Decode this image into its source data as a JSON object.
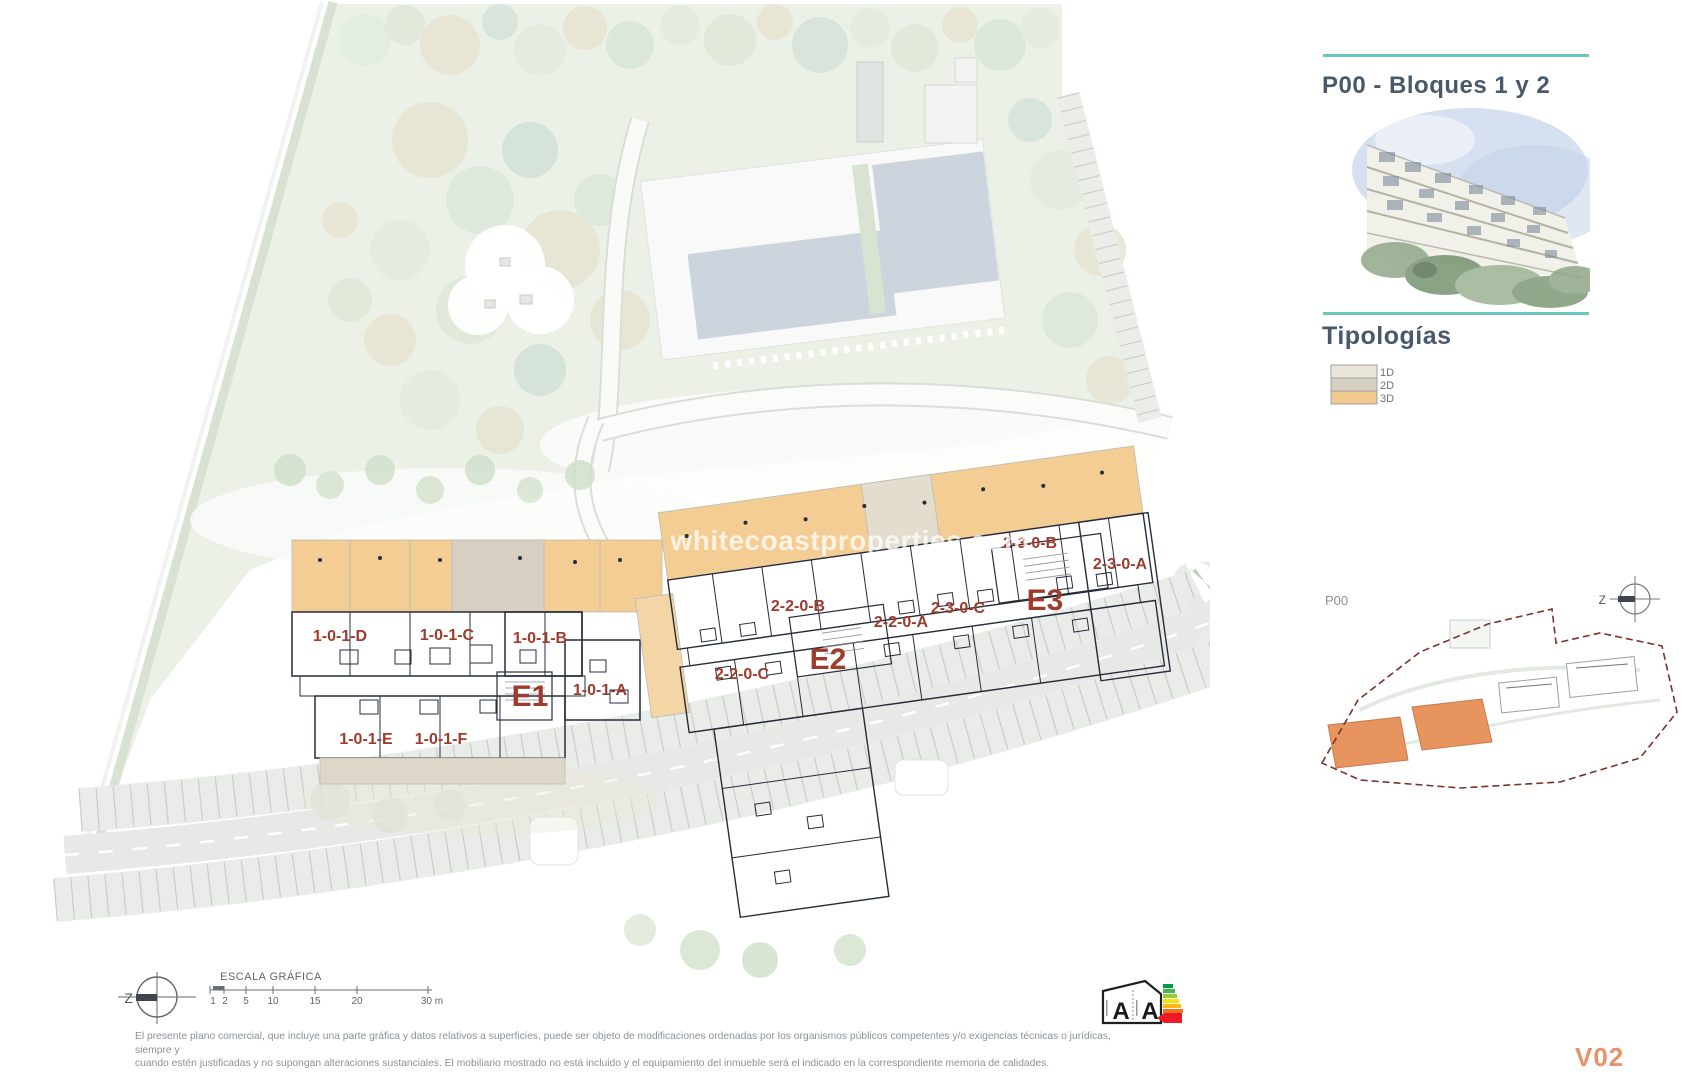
{
  "header": {
    "title": "P00 - Bloques 1 y 2"
  },
  "typologies": {
    "title": "Tipologías",
    "items": [
      {
        "label": "1D",
        "color": "#eae5d8"
      },
      {
        "label": "2D",
        "color": "#d6cfc2"
      },
      {
        "label": "3D",
        "color": "#f2c98e"
      }
    ]
  },
  "minimap": {
    "label": "P00",
    "compass_letter": "Z"
  },
  "plan": {
    "watermark": "whitecoastproperties.com",
    "compass_letter": "Z",
    "blocks": [
      {
        "id": "E1",
        "units": [
          "1-0-1-D",
          "1-0-1-C",
          "1-0-1-B",
          "1-0-1-A",
          "1-0-1-E",
          "1-0-1-F"
        ]
      },
      {
        "id": "E2",
        "units": [
          "2-2-0-B",
          "2-2-0-A",
          "2-2-0-C"
        ]
      },
      {
        "id": "E3",
        "units": [
          "2-3-0-B",
          "2-3-0-C",
          "2-3-0-A"
        ]
      }
    ]
  },
  "scalebar": {
    "title": "ESCALA GRÁFICA",
    "ticks": [
      "1",
      "2",
      "5",
      "10",
      "15",
      "20",
      "30 m"
    ]
  },
  "energy": {
    "left_letter": "A",
    "right_letter": "A"
  },
  "footer": {
    "line1": "El presente plano comercial, que incluye una parte gráfica y datos relativos a superficies, puede ser objeto de modificaciones ordenadas por los organismos públicos competentes y/o exigencias técnicas o jurídicas, siempre y",
    "line2": "cuando estén justificadas y no supongan alteraciones sustanciales. El mobiliario mostrado no está incluido y el equipamiento del inmueble será el indicado en la correspondiente memoria de calidades.",
    "version": "V02"
  },
  "colors": {
    "accent_teal": "#6ac6c1",
    "title_blue": "#49596b",
    "unit_label_red": "#9d3b2c",
    "typology_1d": "#eae5d8",
    "typology_2d": "#d6cfc2",
    "typology_3d": "#f2c98e",
    "plan_wall": "#262c3c",
    "minimap_boundary": "#7a322a",
    "minimap_highlight": "#e8945f",
    "version_orange": "#e8926a"
  }
}
